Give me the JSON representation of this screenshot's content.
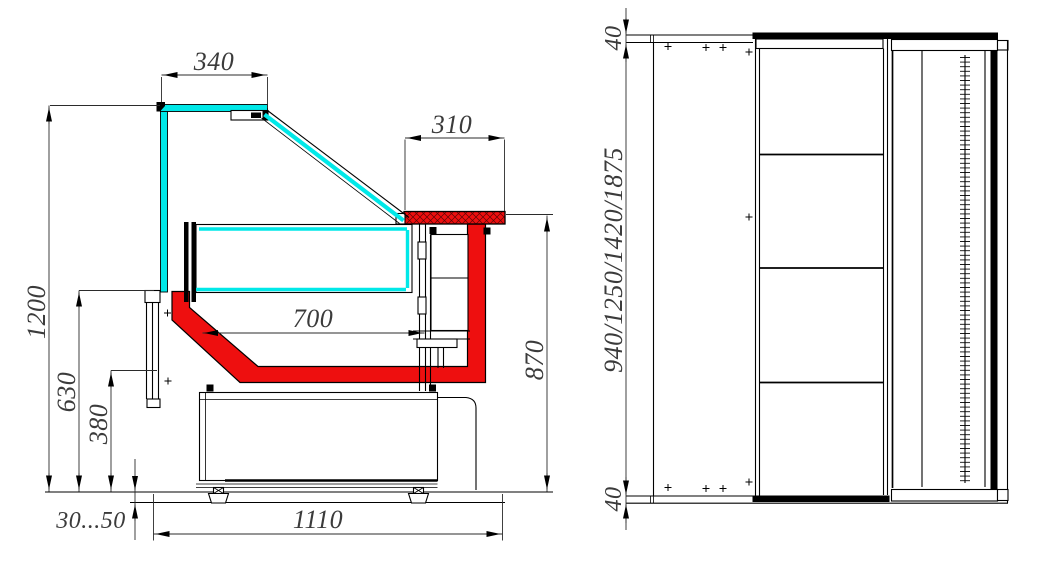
{
  "colors": {
    "background": "#ffffff",
    "glass_cyan": "#00e8e8",
    "profile_red": "#ee0f0f",
    "line_black": "#000000",
    "dim_text_gray": "#3b3b3b"
  },
  "section_view": {
    "dims": {
      "top_glass_width": "340",
      "counter_depth": "310",
      "total_height": "1200",
      "front_glass_height": "630",
      "deck_height": "380",
      "foot_adjustment": "30...50",
      "base_depth": "1110",
      "rear_height": "870",
      "deck_depth": "700"
    }
  },
  "front_view": {
    "dims": {
      "top_trim_height": "40",
      "case_lengths": "940/1250/1420/1875",
      "bottom_trim_height": "40"
    }
  }
}
